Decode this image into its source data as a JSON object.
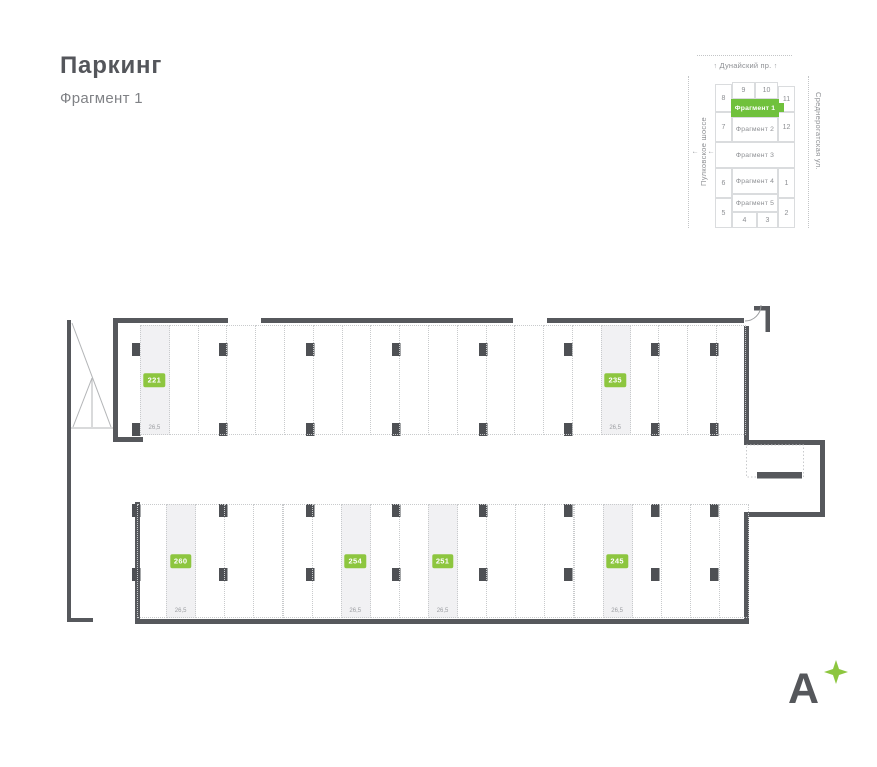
{
  "header": {
    "title": "Паркинг",
    "subtitle": "Фрагмент 1"
  },
  "minimap": {
    "streets": {
      "top": "Дунайский пр.",
      "left": "Пулковское шоссе",
      "right": "Среднерогатская ул."
    },
    "arrow_up": "↑",
    "sections": {
      "n1": "1",
      "n2": "2",
      "n3": "3",
      "n4": "4",
      "n5": "5",
      "n6": "6",
      "n7": "7",
      "n8": "8",
      "n9": "9",
      "n10": "10",
      "n11": "11",
      "n12": "12"
    },
    "fragments": {
      "frag1": {
        "label": "Фрагмент 1",
        "selected": true
      },
      "frag2": {
        "label": "Фрагмент 2",
        "selected": false
      },
      "frag3": {
        "label": "Фрагмент 3",
        "selected": false
      },
      "frag4": {
        "label": "Фрагмент 4",
        "selected": false
      },
      "frag5": {
        "label": "Фрагмент 5",
        "selected": false
      }
    }
  },
  "plan": {
    "highlighted_spaces": [
      {
        "number": "221",
        "area": "26,5",
        "row": "top",
        "slot": 0
      },
      {
        "number": "235",
        "area": "26,5",
        "row": "top",
        "slot": 16
      },
      {
        "number": "260",
        "area": "26,5",
        "row": "bottom",
        "slot": 1
      },
      {
        "number": "254",
        "area": "26,5",
        "row": "bottom",
        "slot": 7
      },
      {
        "number": "251",
        "area": "26,5",
        "row": "bottom",
        "slot": 10
      },
      {
        "number": "245",
        "area": "26,5",
        "row": "bottom",
        "slot": 16
      }
    ]
  },
  "logo": {
    "letter": "А"
  },
  "colors": {
    "accent_green": "#8dc63f",
    "minimap_green": "#70c13c",
    "wall": "#56585c"
  }
}
